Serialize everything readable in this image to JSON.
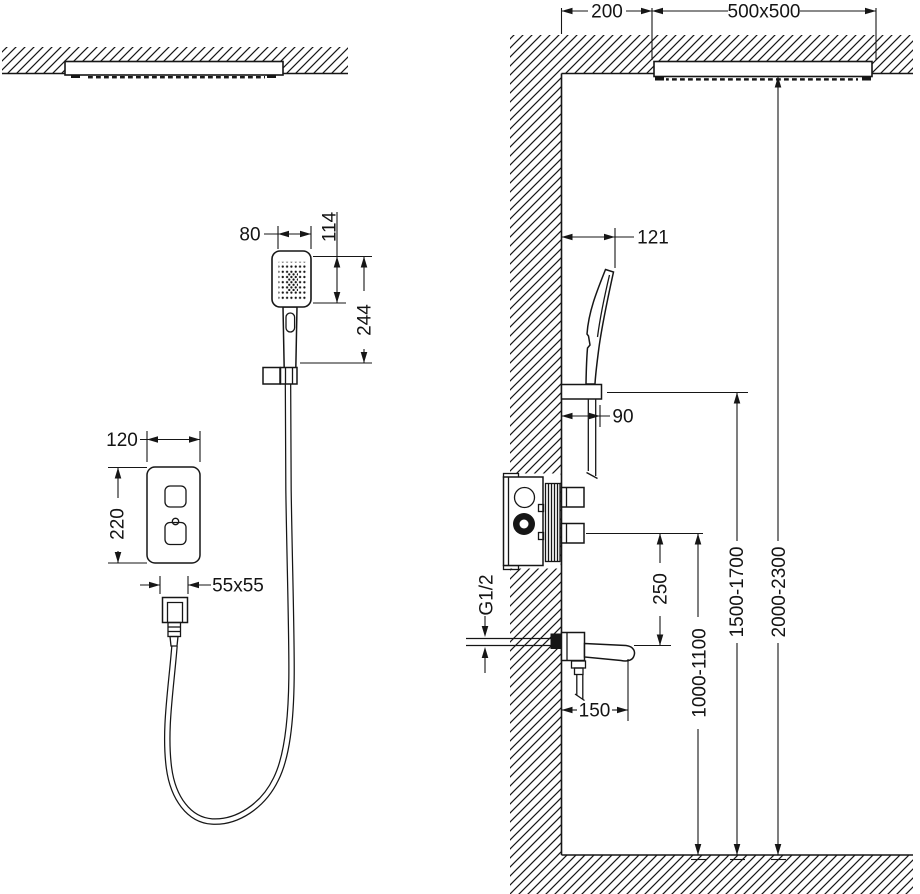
{
  "drawing": {
    "type": "shower-system-installation-diagram",
    "views": {
      "front": "front view",
      "side": "side section view"
    },
    "colors": {
      "line": "#161616",
      "background": "#ffffff"
    }
  },
  "dims": {
    "ceiling_offset": "200",
    "ceiling_shower_size": "500x500",
    "hand_shower_face_width": "80",
    "hand_shower_face_height": "114",
    "hand_shower_length": "244",
    "panel_width": "120",
    "panel_height": "220",
    "outlet_box_size": "55x55",
    "hand_shower_reach": "121",
    "holder_reach": "90",
    "thread_label": "G1/2",
    "mixer_to_spout": "250",
    "spout_length": "150",
    "mixer_height_range": "1000-1100",
    "holder_height_range": "1500-1700",
    "head_height_range": "2000-2300"
  }
}
